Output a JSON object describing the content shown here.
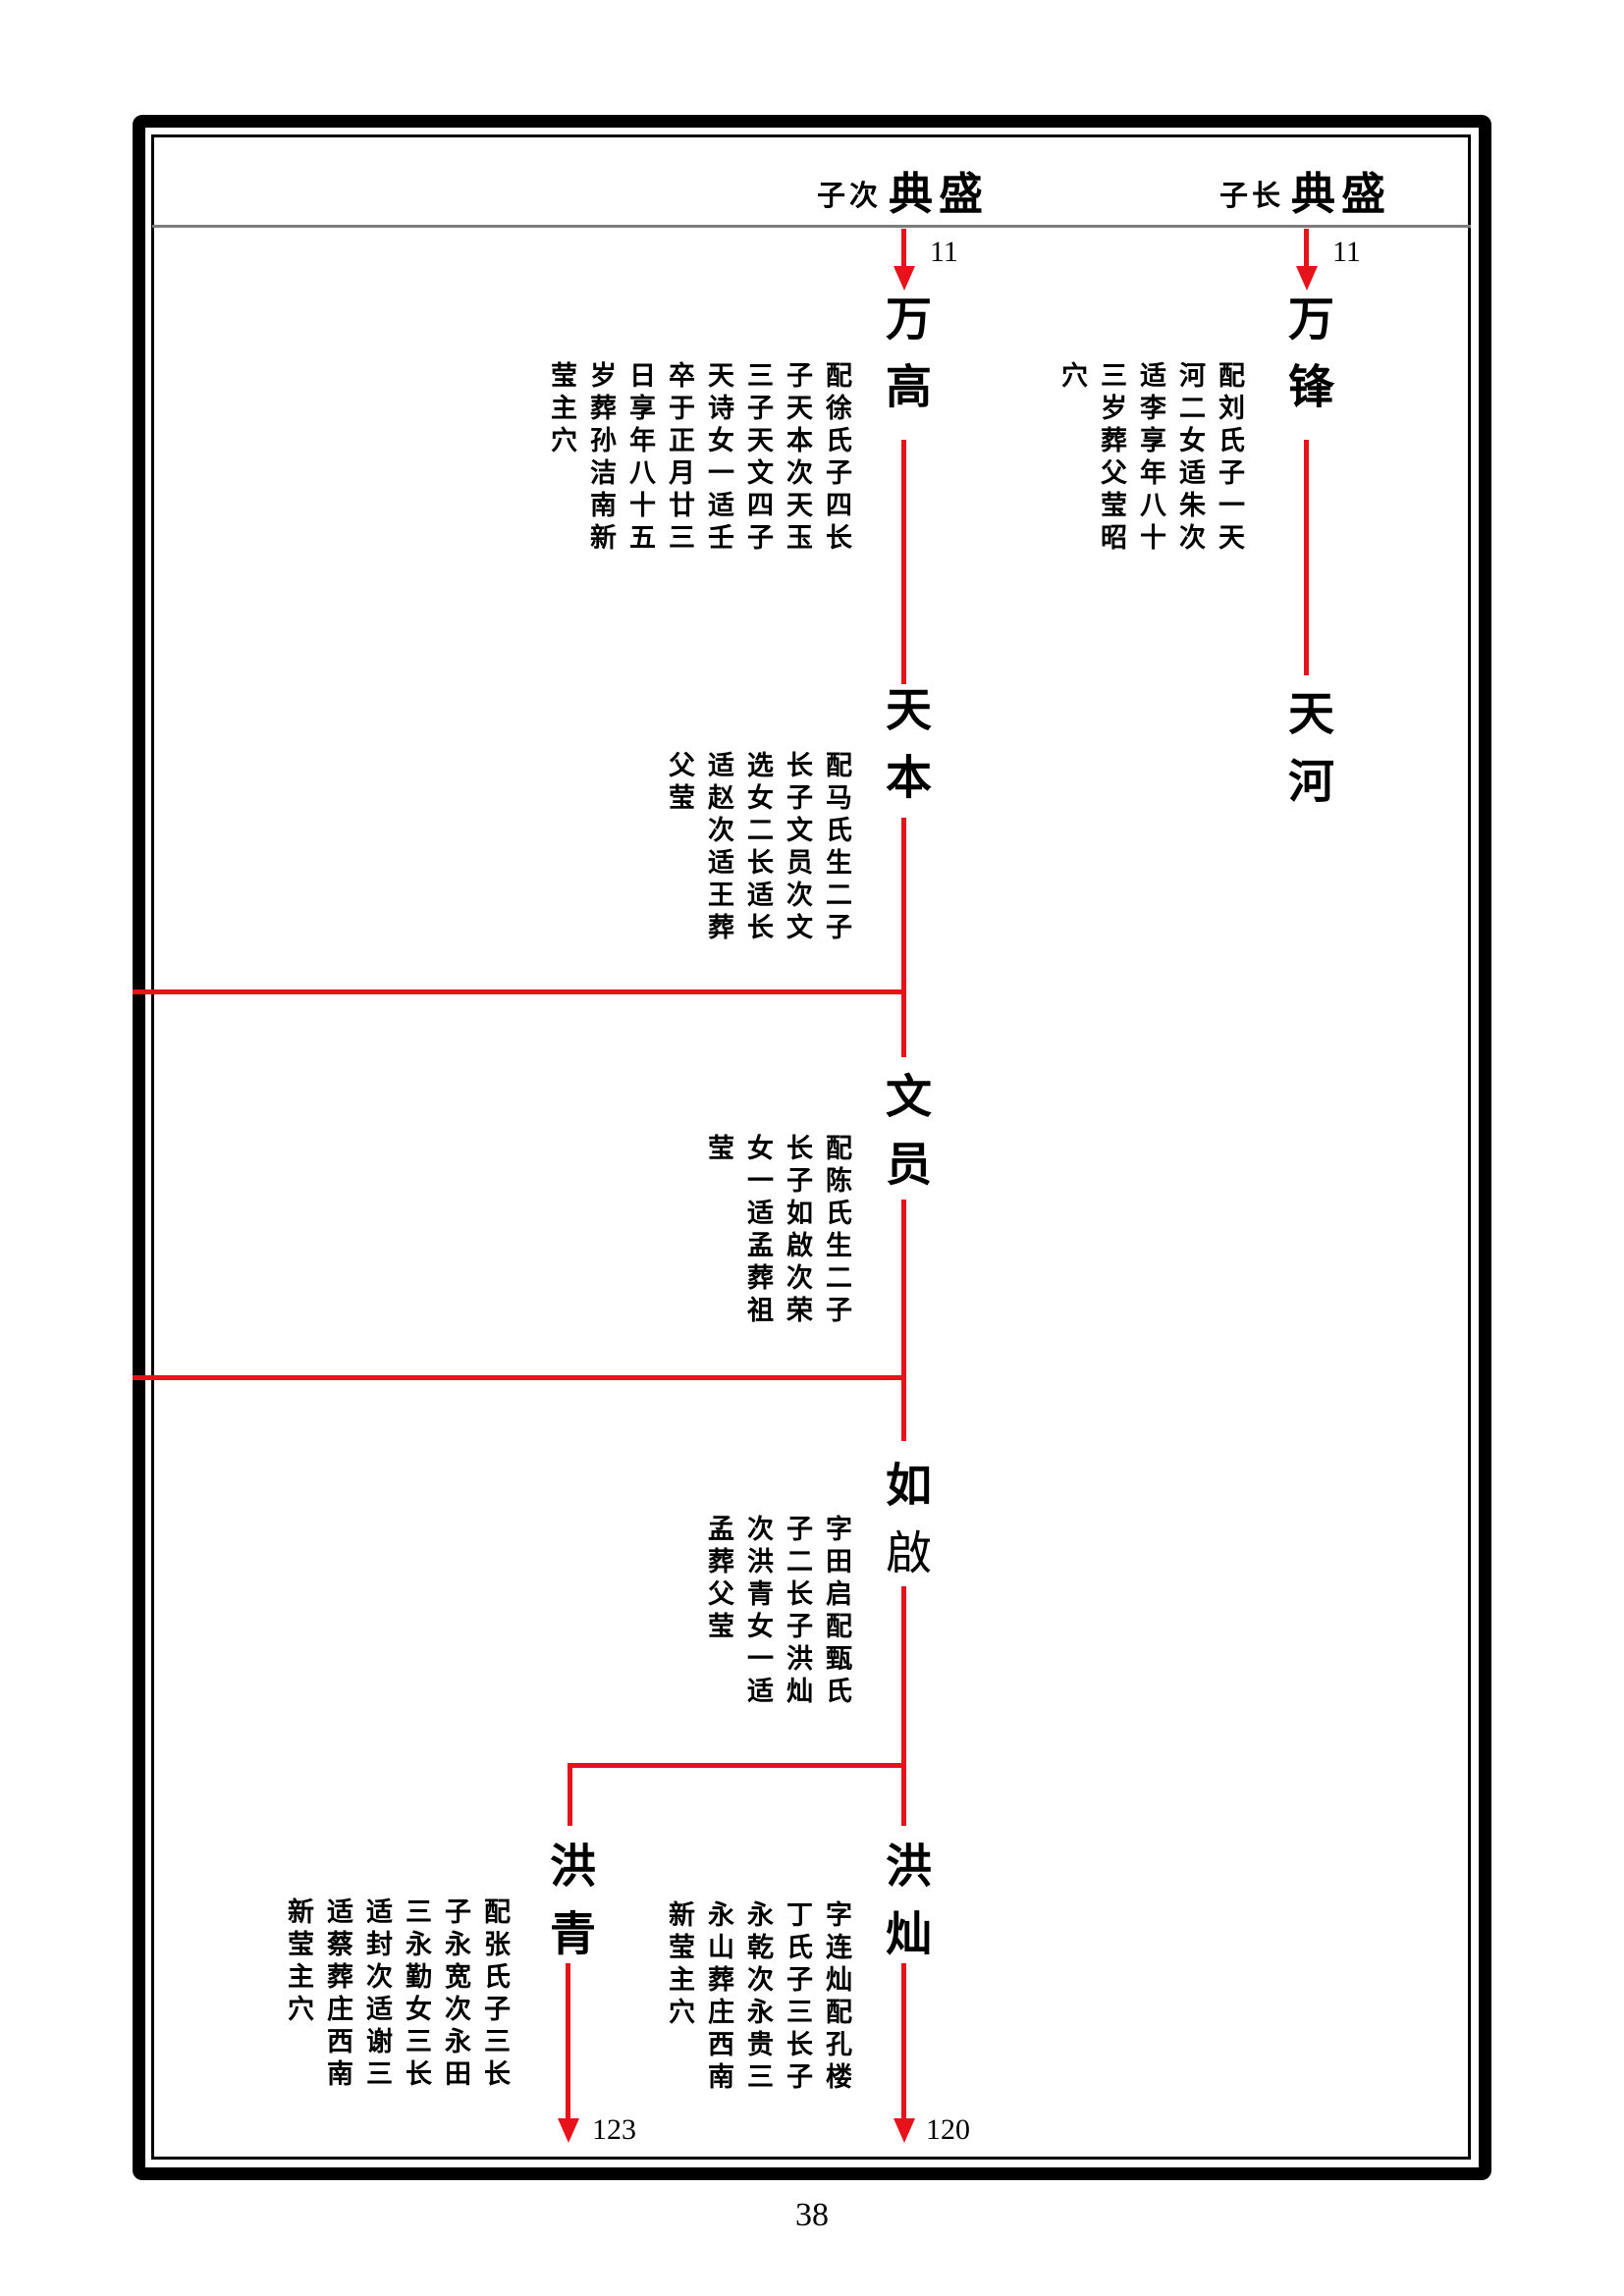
{
  "colors": {
    "line_red": "#e8121b",
    "divider_gray": "#7d7d7d",
    "text_black": "#000000"
  },
  "header": {
    "left": {
      "prefix": "子次",
      "name": "典盛"
    },
    "right": {
      "prefix": "子长",
      "name": "典盛"
    }
  },
  "generation_numbers": {
    "top_left": "11",
    "top_right": "11",
    "bottom_left": "123",
    "bottom_right": "120"
  },
  "people": {
    "wangao": {
      "name": "万高",
      "columns": [
        "配徐氏子四长",
        "子天本次天玉",
        "三子天文四子",
        "天诗女一适壬",
        "卒于正月廿三",
        "日享年八十五",
        "岁葬孙洁南新",
        "莹主穴"
      ]
    },
    "wanfeng": {
      "name": "万锋",
      "columns": [
        "配刘氏子一天",
        "河二女适朱次",
        "适李享年八十",
        "三岁葬父莹昭",
        "穴"
      ]
    },
    "tianben": {
      "name": "天本",
      "columns": [
        "配马氏生二子",
        "长子文员次文",
        "选女二长适长",
        "适赵次适王葬",
        "父莹"
      ]
    },
    "tianhe": {
      "name": "天河"
    },
    "wenyuan": {
      "name": "文员",
      "columns": [
        "配陈氏生二子",
        "长子如啟次荣",
        "女一适孟葬祖",
        "莹"
      ]
    },
    "ruqi": {
      "name_first": "如",
      "name_second": "啟",
      "columns": [
        "字田启配甄氏",
        "子二长子洪灿",
        "次洪青女一适",
        "孟葬父莹"
      ]
    },
    "hongcan": {
      "name": "洪灿",
      "columns": [
        "字连灿配孔楼",
        "丁氏子三长子",
        "永乾次永贵三",
        "永山葬庄西南",
        "新莹主穴"
      ]
    },
    "hongqing": {
      "name": "洪青",
      "columns": [
        "配张氏子三长",
        "子永宽次永田",
        "三永勤女三长",
        "适封次适谢三",
        "适蔡葬庄西南",
        "新莹主穴"
      ]
    }
  },
  "page_number": "38"
}
